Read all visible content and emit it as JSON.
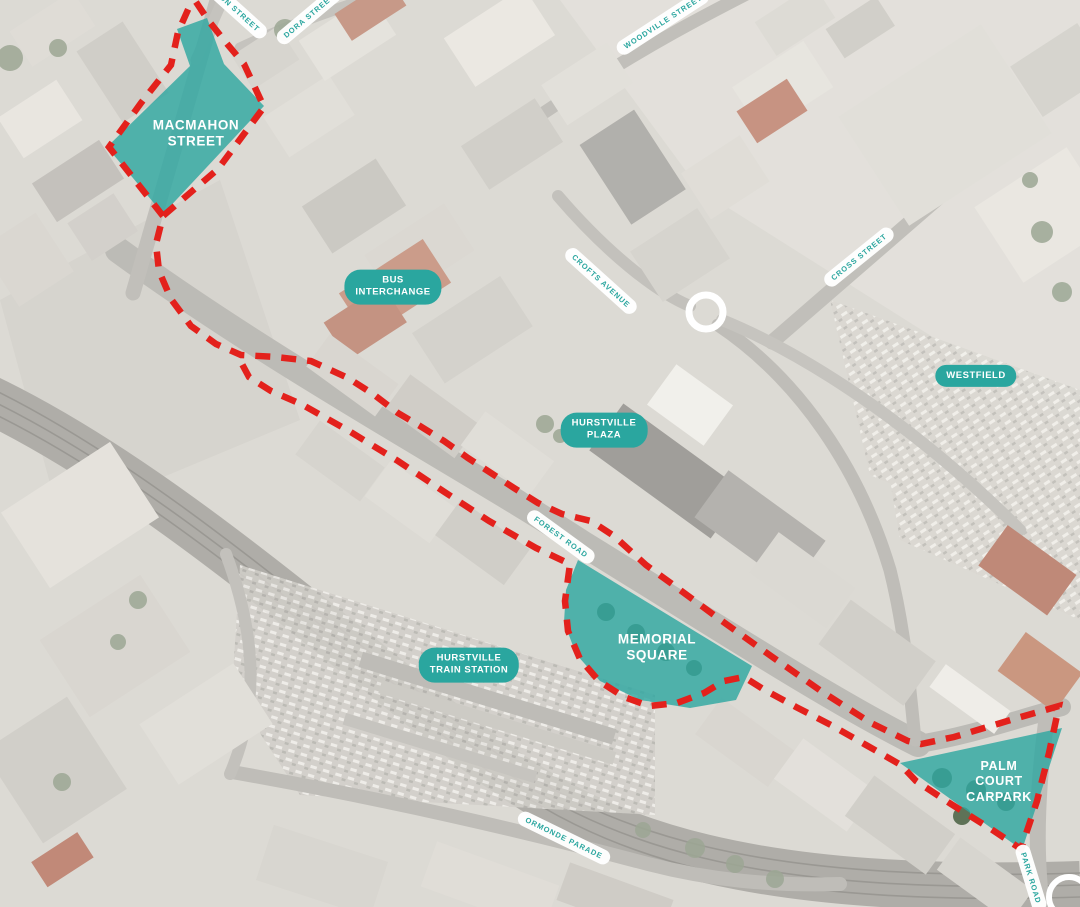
{
  "map": {
    "title": "Hurstville town centre study area aerial map",
    "legend_sites": [
      {
        "id": "macmahon-street-site",
        "lines": [
          "MACMAHON",
          "STREET"
        ]
      },
      {
        "id": "memorial-square-site",
        "lines": [
          "MEMORIAL",
          "SQUARE"
        ]
      },
      {
        "id": "palm-court-carpark-site",
        "lines": [
          "PALM",
          "COURT",
          "CARPARK"
        ]
      }
    ],
    "place_pills": [
      {
        "id": "bus-interchange",
        "lines": [
          "BUS",
          "INTERCHANGE"
        ]
      },
      {
        "id": "hurstville-plaza",
        "lines": [
          "HURSTVILLE",
          "PLAZA"
        ]
      },
      {
        "id": "westfield",
        "lines": [
          "WESTFIELD"
        ]
      },
      {
        "id": "hurstville-train-station",
        "lines": [
          "HURSTVILLE",
          "TRAIN STATION"
        ]
      }
    ],
    "street_pills": [
      {
        "id": "macmahon-street",
        "label": "MACMAHON STREET"
      },
      {
        "id": "dora-street",
        "label": "DORA STREET"
      },
      {
        "id": "woodville-street",
        "label": "WOODVILLE STREET"
      },
      {
        "id": "cross-street",
        "label": "CROSS STREET"
      },
      {
        "id": "crofts-avenue",
        "label": "CROFTS AVENUE"
      },
      {
        "id": "forest-road",
        "label": "FOREST ROAD"
      },
      {
        "id": "ormonde-parade",
        "label": "ORMONDE PARADE"
      },
      {
        "id": "park-road",
        "label": "PARK ROAD"
      }
    ],
    "colors": {
      "highlight_teal": "#2FA7A1",
      "boundary_red": "#E3211C",
      "pill_teal": "#2AA69F",
      "street_text_teal": "#2AA69F",
      "label_white": "#FFFFFF"
    }
  }
}
